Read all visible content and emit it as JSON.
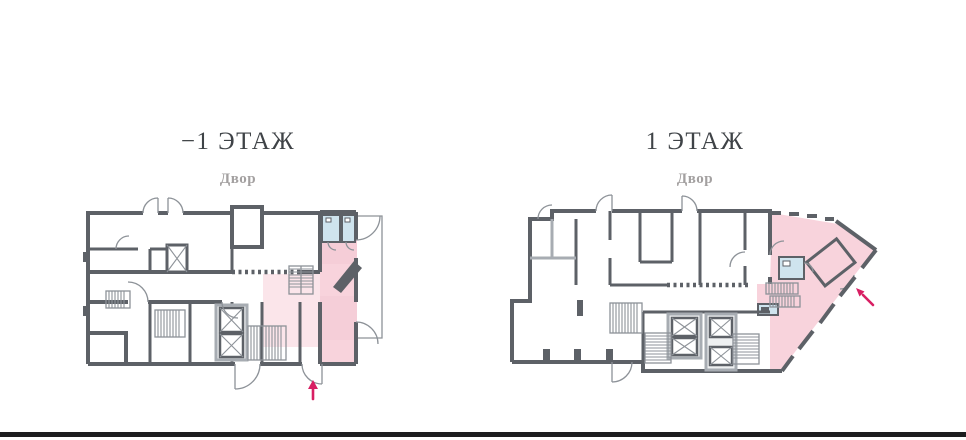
{
  "page": {
    "background": "#ffffff"
  },
  "colors": {
    "wall_dark": "#5d6167",
    "wall_light": "#a7acb2",
    "line_thin": "#8d9298",
    "premise_pink": "#f8d3dc",
    "premise_pink_light": "#fbe5ea",
    "premise_pink_shade": "#f2c5d1",
    "wet_room_blue": "#cfe4ee",
    "arrow_accent": "#d81f63",
    "title_text": "#3f4347",
    "label_text": "#a3a0a0",
    "footer_rule": "#1d1d1f",
    "page_bg": "#ffffff"
  },
  "plans": [
    {
      "id": "floor-minus-1",
      "title": "−1 ЭТАЖ",
      "courtyard_label": "Двор",
      "entrance_arrow_icon": "arrow-up"
    },
    {
      "id": "floor-1",
      "title": "1 ЭТАЖ",
      "courtyard_label": "Двор",
      "entrance_arrow_icon": "arrow-up-left"
    }
  ]
}
